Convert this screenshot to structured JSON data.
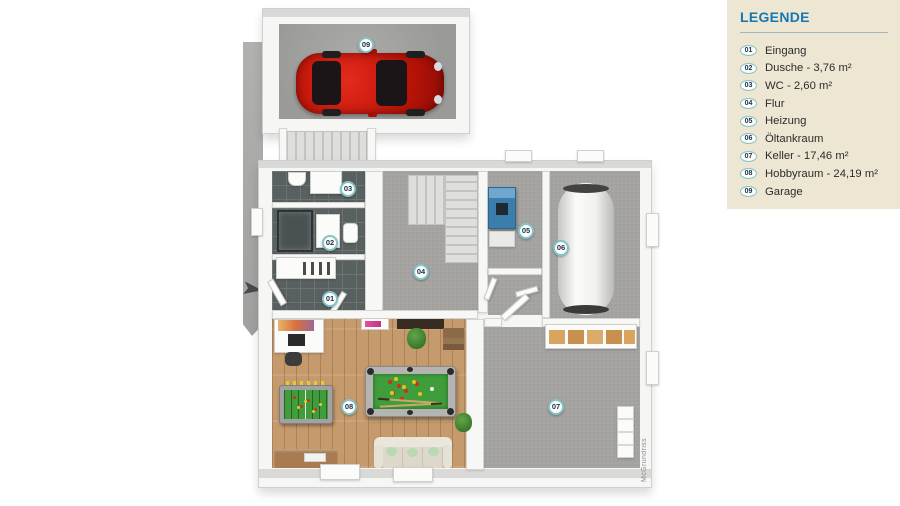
{
  "legend": {
    "title": "LEGENDE",
    "items": [
      {
        "num": "01",
        "label": "Eingang"
      },
      {
        "num": "02",
        "label": "Dusche - 3,76 m²"
      },
      {
        "num": "03",
        "label": "WC - 2,60 m²"
      },
      {
        "num": "04",
        "label": "Flur"
      },
      {
        "num": "05",
        "label": "Heizung"
      },
      {
        "num": "06",
        "label": "Öltankraum"
      },
      {
        "num": "07",
        "label": "Keller - 17,46 m²"
      },
      {
        "num": "08",
        "label": "Hobbyraum - 24,19 m²"
      },
      {
        "num": "09",
        "label": "Garage"
      }
    ]
  },
  "plan": {
    "markers": [
      {
        "id": "01"
      },
      {
        "id": "02"
      },
      {
        "id": "03"
      },
      {
        "id": "04"
      },
      {
        "id": "05"
      },
      {
        "id": "06"
      },
      {
        "id": "07"
      },
      {
        "id": "08"
      },
      {
        "id": "09"
      }
    ],
    "watermark": "McGrundriss"
  },
  "colors": {
    "legend-bg": "#ece6d2",
    "legend-title": "#1678b3",
    "badge-border": "#82c4c8",
    "badge-bg": "#fdfdf9",
    "badge-text": "#20304e",
    "text": "#2c2c2c",
    "carpet": "#a6a5a2",
    "tile": "#596060",
    "wood": "#c59a6c",
    "felt": "#3f9e3b",
    "car-red": "#c01408",
    "boiler-blue": "#3b7dab"
  }
}
